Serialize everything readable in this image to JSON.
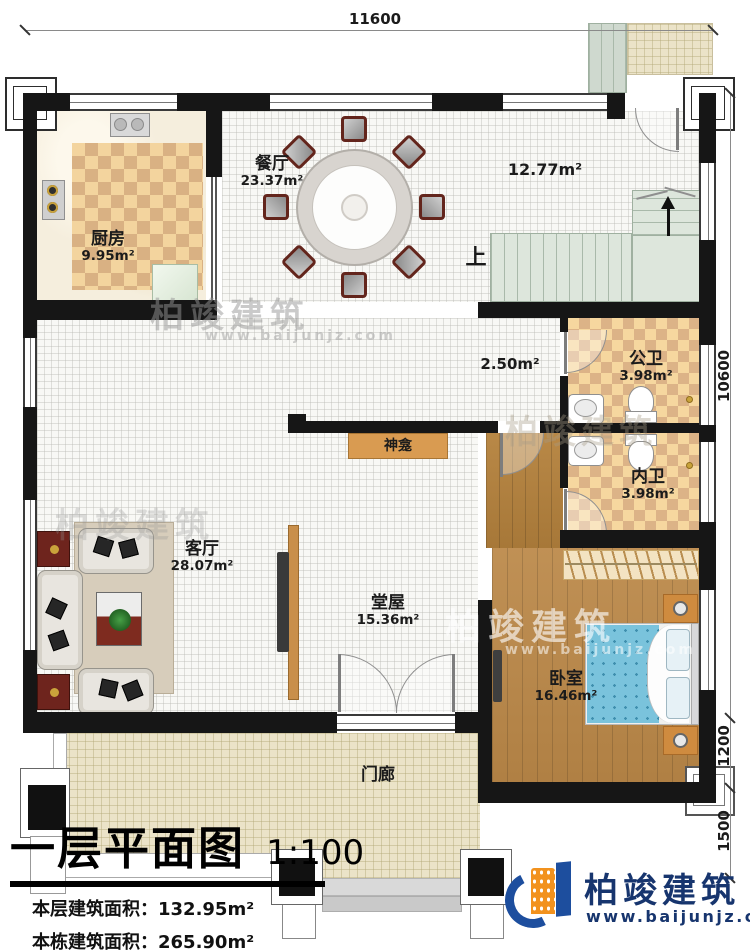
{
  "dimensions": {
    "top": "11600",
    "right_upper": "10600",
    "right_middle": "1200",
    "right_lower": "1500"
  },
  "rooms": {
    "kitchen": {
      "name": "厨房",
      "area": "9.95m²"
    },
    "dining": {
      "name": "餐厅",
      "area": "23.37m²"
    },
    "stair_hall": {
      "area": "12.77m²"
    },
    "stairs": {
      "up_label": "上"
    },
    "inner_hall": {
      "area": "2.50m²"
    },
    "public_bath": {
      "name": "公卫",
      "area": "3.98m²"
    },
    "private_bath": {
      "name": "内卫",
      "area": "3.98m²"
    },
    "shrine": {
      "name": "神龛"
    },
    "living": {
      "name": "客厅",
      "area": "28.07m²"
    },
    "main_hall": {
      "name": "堂屋",
      "area": "15.36m²"
    },
    "bedroom": {
      "name": "卧室",
      "area": "16.46m²"
    },
    "porch": {
      "name": "门廊"
    }
  },
  "title_block": {
    "title": "一层平面图",
    "scale": "1:100",
    "line1": "本层建筑面积：132.95m²",
    "line2": "本栋建筑面积：265.90m²",
    "line3a": "占地面积：160.76m²",
    "line3b": "层高：3.6m"
  },
  "brand": {
    "name": "柏竣建筑",
    "website": "www.baijunjz.com"
  }
}
